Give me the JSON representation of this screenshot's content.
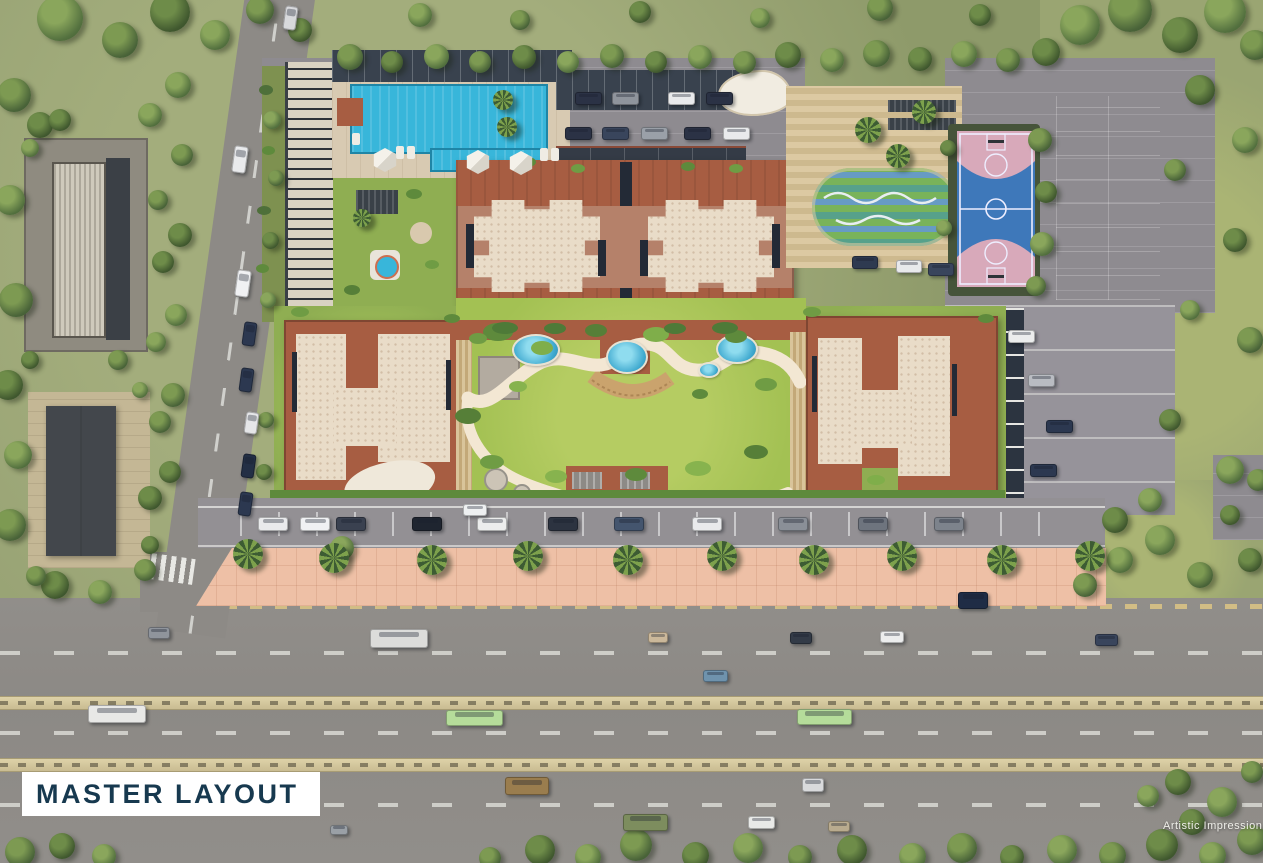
{
  "page": {
    "title_label": "MASTER LAYOUT",
    "watermark": "Artistic Impression"
  },
  "colors": {
    "label_text": "#17394f",
    "label_bg": "#ffffff",
    "pool_water": "#38b6da",
    "lawn_green": "#a3c153",
    "roof_terracotta": "#a75d42",
    "building_tan": "#b5816a",
    "rooftop_beige": "#e9dcc8",
    "court_blue": "#3e78ba",
    "court_pink": "#d8a9ba",
    "play_teal": "#57a18b",
    "road_gray": "#8f8c88",
    "promenade_pink": "#eec0a6",
    "median_beige": "#d6c9a0"
  }
}
